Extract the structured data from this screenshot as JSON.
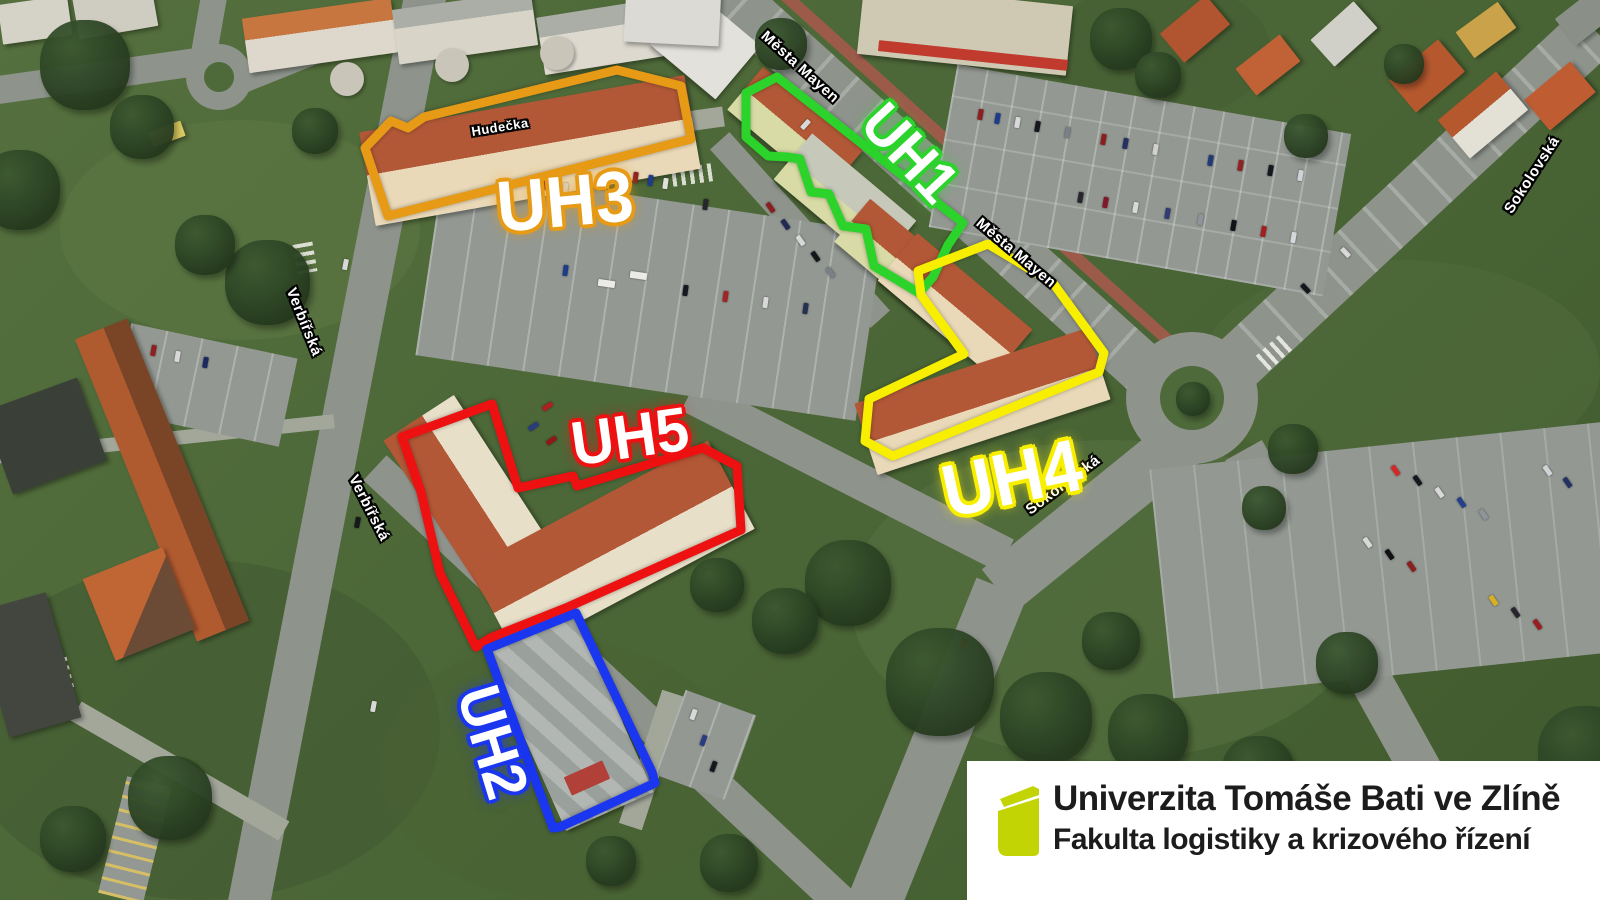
{
  "overlays": {
    "uh1": {
      "label": "UH1",
      "color": "#2bd32b"
    },
    "uh2": {
      "label": "UH2",
      "color": "#1a36ee"
    },
    "uh3": {
      "label": "UH3",
      "color": "#e79a15"
    },
    "uh4": {
      "label": "UH4",
      "color": "#f7ee00"
    },
    "uh5": {
      "label": "UH5",
      "color": "#ee1111"
    }
  },
  "streets": {
    "mesta_mayen_north": "Města Mayen",
    "mesta_mayen_south": "Města Mayen",
    "verbirska_north": "Verbířská",
    "verbirska_south": "Verbířská",
    "sokolovska_mid": "Sokolovská",
    "sokolovska_east": "Sokolovská",
    "hudecka": "Hudečka"
  },
  "logo": {
    "university": "Univerzita Tomáše Bati ve Zlíně",
    "faculty": "Fakulta logistiky a krizového řízení",
    "book_color": "#c3d405"
  }
}
